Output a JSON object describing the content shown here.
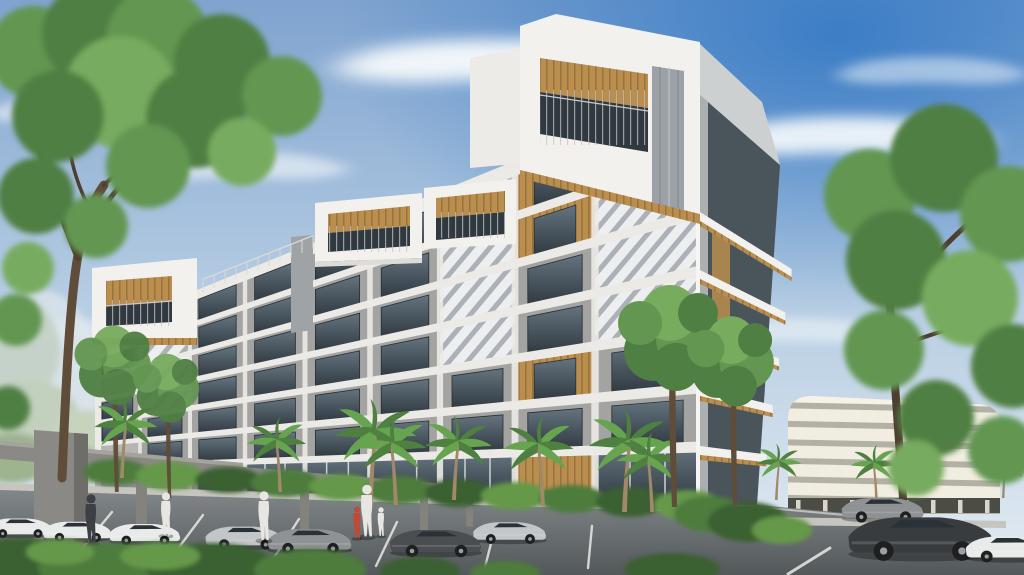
{
  "scene": {
    "type": "architectural-rendering",
    "description": "Daytime exterior rendering of a modern white mid-rise apartment building with stepped rooftop balcony boxes, wood-slat soffits, gray panels and chevron-patterned facade strips, palm and tree landscaping, a gray entry pergola, a surface parking lot with sedans and pedestrians, and a white multi-level parking garage at right under a blue partly-cloudy sky"
  },
  "palette": {
    "skyTop": "#7fa3cf",
    "skyMid": "#b9cfe4",
    "skyHorizon": "#e3ebf2",
    "skyRightBlue": "#2f76c4",
    "cloud": "#f7fafc",
    "white": "#f2f1ed",
    "whiteShade": "#dddcd7",
    "grid": "#eceae6",
    "panelGray": "#a3a4a1",
    "panelGray2": "#b6b5b1",
    "panelDark": "#8e8d89",
    "glassDark": "#303940",
    "glassLight": "#64747f",
    "wood": "#b98e4e",
    "woodDark": "#8f6a35",
    "patternBg": "#eceeef",
    "patternLine": "#9ba1a7",
    "rightFaceLight": "#cdd0d1",
    "rightFaceDark": "#4a545b",
    "garageBand": "#f1ede1",
    "garageGap": "#b3b0a5",
    "garageDark": "#4b4c44",
    "canopyGray": "#8b8985",
    "canopyDark": "#6f6d69",
    "asphaltNear": "#53585b",
    "asphaltFar": "#83888a",
    "marking": "#e9e9e7",
    "sidewalk": "#c6c5bf",
    "curb": "#dddcd6",
    "hedge": "#4d7c3c",
    "hedgeDark": "#3a6130",
    "hedgeLight": "#65984a",
    "treeG1": "#4f7f42",
    "treeG2": "#629651",
    "treeG3": "#77ab5e",
    "trunk": "#5f4c39",
    "branch": "#4e3e2f",
    "palmTrunk": "#a08868",
    "palmG1": "#4e8040",
    "palmG2": "#67a450",
    "carWhite": "#e9eaea",
    "carSilver": "#c3c6c8",
    "carGray": "#8f9294",
    "carDark": "#4a4e51",
    "carBlack": "#383c3f",
    "wheel": "#1d1f21",
    "carGlass": "#2b3237",
    "skin": "#c9a183",
    "shirtWhite": "#e8e6e2",
    "shirtRed": "#c04a35",
    "pantsDark": "#3c4044",
    "distantHaze": "#c2d0bd",
    "fenceWhite": "#eceae4"
  },
  "sky": {
    "clouds": [
      [
        500,
        60,
        3.2,
        1.6,
        0.95
      ],
      [
        850,
        135,
        2.6,
        1.4,
        0.9
      ],
      [
        240,
        165,
        2.0,
        1.0,
        0.6
      ],
      [
        660,
        225,
        1.6,
        0.8,
        0.5
      ],
      [
        60,
        110,
        1.4,
        0.9,
        0.55
      ],
      [
        930,
        70,
        1.8,
        1.0,
        0.5
      ],
      [
        795,
        330,
        2.0,
        0.9,
        0.5
      ],
      [
        120,
        330,
        2.2,
        0.8,
        0.45
      ]
    ]
  },
  "building": {
    "vp": [
      -265,
      478
    ],
    "x0": 95,
    "x1": 700,
    "levels": [
      95,
      154,
      213,
      271,
      330,
      388,
      447,
      505
    ],
    "bays": [
      95,
      140,
      190,
      245,
      305,
      370,
      440,
      515,
      595,
      700
    ],
    "cells": [
      "spggggpwp",
      "gpggggpwp",
      "spggggpgp",
      "gpggggpgp",
      "gggggggwg",
      "sgggggggg",
      "ssgGGGGWG"
    ],
    "railing": {
      "x0": 203,
      "x1": 313,
      "step": 11,
      "h": 13,
      "level": 95
    }
  },
  "rightFace": {
    "slabs": [
      [
        213,
        791.6,
        270.0
      ],
      [
        271,
        785.4,
        313.6
      ],
      [
        330,
        779.1,
        359.5
      ],
      [
        388,
        772.8,
        406.1
      ],
      [
        447,
        766.4,
        455.4
      ]
    ]
  },
  "garage": {
    "x": 782,
    "w": 224,
    "topY": 392,
    "bandH": 12.5,
    "step": 18.5,
    "count": 6,
    "openY": 498,
    "openH": 15,
    "pillarStep": 27
  },
  "placements": {
    "palms": [
      [
        120,
        478,
        0.85,
        0
      ],
      [
        282,
        492,
        0.8,
        1
      ],
      [
        368,
        502,
        1.1,
        0
      ],
      [
        398,
        505,
        0.95,
        1
      ],
      [
        452,
        500,
        0.9,
        0
      ],
      [
        545,
        506,
        0.95,
        1
      ],
      [
        622,
        512,
        1.1,
        0
      ],
      [
        654,
        512,
        0.85,
        1
      ],
      [
        775,
        500,
        0.6,
        0
      ],
      [
        878,
        503,
        0.62,
        1
      ],
      [
        1002,
        498,
        0.55,
        0
      ]
    ],
    "backTrees": [
      [
        115,
        492,
        1.5
      ],
      [
        168,
        498,
        1.3
      ]
    ],
    "cornerTrees": [
      [
        672,
        507,
        2.0
      ],
      [
        733,
        505,
        1.7
      ]
    ],
    "cars": [
      {
        "name": "distant-white-car",
        "x": -16,
        "y": 512,
        "s": 0.72,
        "color": "carWhite"
      },
      {
        "name": "white-sedan-1",
        "x": 40,
        "y": 515,
        "s": 0.75,
        "color": "carWhite"
      },
      {
        "name": "white-sedan-2",
        "x": 106,
        "y": 517,
        "s": 0.78,
        "color": "carWhite"
      },
      {
        "name": "silver-sedan-1",
        "x": 202,
        "y": 519,
        "s": 0.85,
        "color": "carSilver"
      },
      {
        "name": "gray-sedan",
        "x": 264,
        "y": 521,
        "s": 0.92,
        "color": "carGray"
      },
      {
        "name": "silver-sedan-2",
        "x": 470,
        "y": 515,
        "s": 0.8,
        "color": "carSilver"
      },
      {
        "name": "dark-sedan",
        "x": 386,
        "y": 521,
        "s": 1.0,
        "color": "carDark"
      },
      {
        "name": "gray-car-right",
        "x": 838,
        "y": 490,
        "s": 0.9,
        "color": "carGray"
      },
      {
        "name": "dark-coupe",
        "x": 842,
        "y": 503,
        "s": 1.6,
        "color": "carBlack"
      },
      {
        "name": "white-car-right",
        "x": 962,
        "y": 528,
        "s": 0.95,
        "color": "carWhite"
      }
    ],
    "people": [
      {
        "name": "pedestrian-1",
        "x": 91,
        "y": 521,
        "s": 1.7,
        "color": "pantsDark"
      },
      {
        "name": "pedestrian-2",
        "x": 166,
        "y": 516,
        "s": 1.5,
        "color": "shirtWhite"
      },
      {
        "name": "pedestrian-3",
        "x": 264,
        "y": 518,
        "s": 1.7,
        "color": "shirtWhite"
      },
      {
        "name": "adult-with-kids",
        "x": 367,
        "y": 513,
        "s": 1.8,
        "color": "shirtWhite"
      },
      {
        "name": "child-red-shirt",
        "x": 357,
        "y": 524,
        "s": 1.1,
        "color": "shirtRed"
      },
      {
        "name": "child-white-shirt",
        "x": 381,
        "y": 523,
        "s": 1.0,
        "color": "shirtWhite"
      }
    ]
  }
}
